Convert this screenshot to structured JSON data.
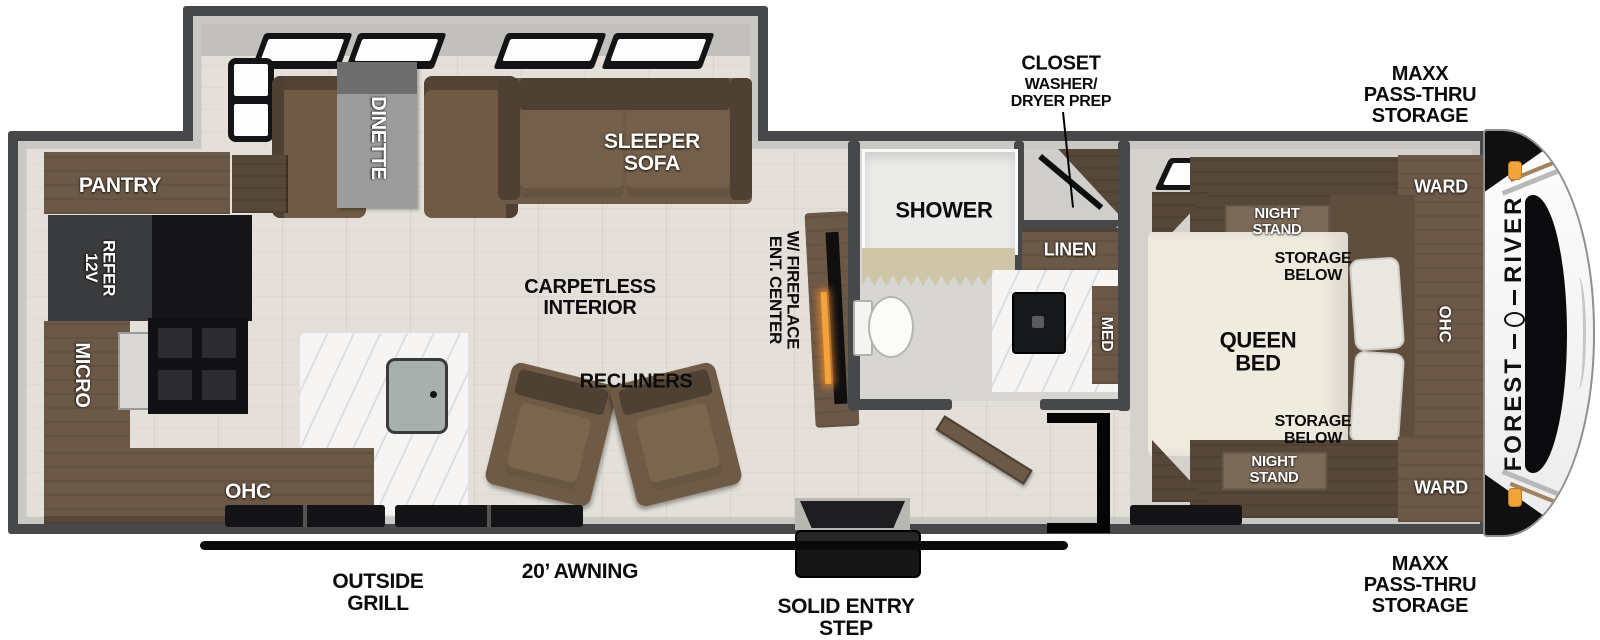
{
  "colors": {
    "wall": "#47484a",
    "wall_inner": "#c9c8c4",
    "floor": "#e4e0d9",
    "bath_floor": "#d8d6d2",
    "cabinet_brown": "#6b5847",
    "cabinet_dark": "#574738",
    "sofa_brown": "#6f5b45",
    "sofa_dark": "#4e4134",
    "table_gray": "#9c9c9c",
    "bed_cream": "#f0ebdf",
    "counter_marble": "#f6f5f3",
    "appliance_black": "#151517",
    "refer_gray": "#3a3b3d",
    "accent_orange": "#f2a33c",
    "awning_black": "#0a0a0a"
  },
  "brand": {
    "first": "FOREST",
    "second": "RIVER"
  },
  "exterior": {
    "maxx_storage": "MAXX\nPASS-THRU\nSTORAGE",
    "closet_title": "CLOSET",
    "closet_sub": "WASHER/\nDRYER PREP",
    "awning": "20’ AWNING",
    "outside_grill": "OUTSIDE\nGRILL",
    "entry_step": "SOLID ENTRY\nSTEP"
  },
  "living": {
    "dinette": "DINETTE",
    "sleeper_sofa": "SLEEPER\nSOFA",
    "carpetless": "CARPETLESS\nINTERIOR",
    "recliners": "RECLINERS",
    "ent_center": "ENT. CENTER\nW/ FIREPLACE"
  },
  "kitchen": {
    "pantry": "PANTRY",
    "refer": "12V\nREFER",
    "micro": "MICRO",
    "ohc": "OHC"
  },
  "bath": {
    "shower": "SHOWER",
    "linen": "LINEN",
    "med": "MED"
  },
  "bedroom": {
    "queen_bed": "QUEEN\nBED",
    "night_stand": "NIGHT\nSTAND",
    "storage_below": "STORAGE\nBELOW",
    "ward": "WARD",
    "ohc": "OHC"
  }
}
